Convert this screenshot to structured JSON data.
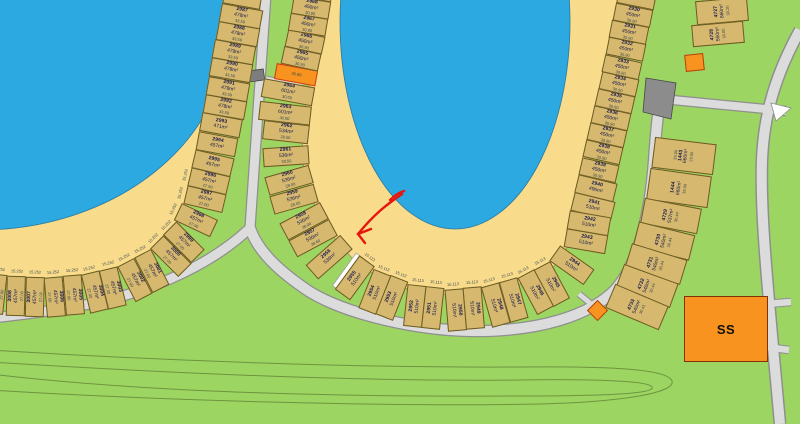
{
  "colors": {
    "water": "#2ba9e0",
    "sand": "#f8db8b",
    "grass": "#9cd561",
    "road": "#dcdcdc",
    "lot_fill": "#d6b96e",
    "orange": "#f7931e",
    "arrow": "#e8150d"
  },
  "buildings": {
    "ss_label": "SS"
  },
  "annotation": {
    "color": "#e8150d"
  },
  "rings": {
    "right": {
      "lots": [
        {
          "p": true
        },
        {
          "n": "2930",
          "a": "450m²",
          "d": "30.90"
        },
        {
          "n": "2931",
          "a": "450m²",
          "d": "30.90"
        },
        {
          "n": "2932",
          "a": "450m²",
          "d": "30.90"
        },
        {
          "n": "2933",
          "a": "450m²",
          "d": "30.90"
        },
        {
          "n": "2934",
          "a": "450m²",
          "d": "30.90"
        },
        {
          "n": "2935",
          "a": "450m²",
          "d": "30.90"
        },
        {
          "n": "2936",
          "a": "450m²",
          "d": "30.90"
        },
        {
          "n": "2937",
          "a": "450m²",
          "d": "30.90"
        },
        {
          "n": "2938",
          "a": "450m²",
          "d": "30.90"
        },
        {
          "n": "2939",
          "a": "450m²",
          "d": "30.90"
        },
        {
          "n": "2940",
          "a": "496m²"
        },
        {
          "n": "2941",
          "a": "510m²"
        },
        {
          "n": "2942",
          "a": "510m²"
        },
        {
          "n": "2943",
          "a": "510m²"
        },
        {
          "n": "2944",
          "a": "510m²"
        },
        {
          "n": "2945",
          "a": "510m²",
          "f": "15.113"
        },
        {
          "n": "2946",
          "a": "510m²",
          "f": "15.113"
        },
        {
          "n": "2947",
          "a": "510m²",
          "f": "15.113"
        },
        {
          "n": "2948",
          "a": "510m²",
          "f": "15.113"
        },
        {
          "n": "2949",
          "a": "510m²",
          "f": "15.113"
        },
        {
          "n": "2950",
          "a": "510m²",
          "f": "15.113"
        },
        {
          "n": "2951",
          "a": "510m²",
          "f": "15.113"
        },
        {
          "n": "2952",
          "a": "510m²",
          "f": "15.113"
        },
        {
          "n": "2953",
          "a": "510m²",
          "f": "15.113"
        },
        {
          "n": "2954",
          "a": "510m²",
          "f": "15.113"
        },
        {
          "n": "2955",
          "a": "510m²",
          "f": "15.113"
        },
        {
          "g": true
        },
        {
          "n": "2956",
          "a": "536m²"
        },
        {
          "n": "2957",
          "a": "536m²",
          "d": "28.60"
        },
        {
          "n": "2958",
          "a": "536m²",
          "d": "28.00"
        },
        {
          "n": "2959",
          "a": "536m²",
          "d": "28.00"
        },
        {
          "n": "2960",
          "a": "536m²",
          "d": "28.00"
        },
        {
          "n": "2961",
          "a": "536m²",
          "d": "28.50"
        },
        {
          "n": "2962",
          "a": "534m²",
          "d": "28.50"
        },
        {
          "n": "2963",
          "a": "601m²",
          "d": "30.00"
        },
        {
          "n": "2964",
          "a": "601m²",
          "d": "30.00"
        },
        {
          "o": true,
          "d": "35.99"
        },
        {
          "n": "2965",
          "a": "450m²",
          "d": "30.90"
        },
        {
          "n": "2966",
          "a": "450m²",
          "d": "30.90"
        },
        {
          "n": "2967",
          "a": "450m²",
          "d": "30.90"
        },
        {
          "n": "2968",
          "a": "450m²",
          "d": "30.90"
        },
        {
          "p": true
        }
      ]
    },
    "left": {
      "lots": [
        {
          "p": true
        },
        {
          "n": "2987",
          "a": "478m²",
          "d": "33.59"
        },
        {
          "n": "2988",
          "a": "478m²",
          "d": "33.59"
        },
        {
          "n": "2989",
          "a": "478m²",
          "d": "33.59"
        },
        {
          "n": "2990",
          "a": "478m²",
          "d": "33.59"
        },
        {
          "n": "2991",
          "a": "478m²",
          "d": "33.59"
        },
        {
          "n": "2992",
          "a": "478m²",
          "d": "33.59"
        },
        {
          "n": "2993",
          "a": "471m²"
        },
        {
          "n": "2994",
          "a": "457m²"
        },
        {
          "n": "2995",
          "a": "457m²"
        },
        {
          "n": "2996",
          "a": "457m²",
          "d": "27.00",
          "f": "15.252"
        },
        {
          "n": "2997",
          "a": "457m²",
          "d": "27.00",
          "f": "15.252"
        },
        {
          "n": "2998",
          "a": "457m²",
          "d": "27.00",
          "f": "15.252"
        },
        {
          "n": "2999",
          "a": "457m²",
          "d": "27.00",
          "f": "15.252"
        },
        {
          "n": "3000",
          "a": "457m²",
          "d": "27.00",
          "f": "15.252"
        },
        {
          "n": "3001",
          "a": "457m²",
          "d": "27.00",
          "f": "15.252"
        },
        {
          "n": "3002",
          "a": "457m²",
          "d": "27.00",
          "f": "15.252"
        },
        {
          "n": "3003",
          "a": "457m²",
          "d": "27.00",
          "f": "15.252"
        },
        {
          "n": "3004",
          "a": "457m²",
          "d": "27.00",
          "f": "15.252"
        },
        {
          "n": "3005",
          "a": "457m²",
          "d": "27.00",
          "f": "15.252"
        },
        {
          "n": "3006",
          "a": "457m²",
          "d": "27.00",
          "f": "15.252"
        },
        {
          "n": "3007",
          "a": "457m²",
          "d": "27.00",
          "f": "15.252"
        },
        {
          "n": "3008",
          "a": "457m²",
          "d": "27.00",
          "f": "15.252"
        },
        {
          "n": "3009",
          "a": "457m²",
          "d": "27.00",
          "f": "15.252"
        },
        {
          "p": true
        }
      ]
    }
  },
  "columns": {
    "c4727": {
      "lots": [
        {
          "p": true
        },
        {
          "n": "4727",
          "a": "660m²",
          "d": "33.20"
        },
        {
          "n": "4728",
          "a": "550m²",
          "d": "33.00"
        }
      ]
    },
    "c1443": {
      "lots": [
        {
          "n": "1443",
          "a": "660m²",
          "d": "23.00",
          "t": "33.00"
        },
        {
          "n": "1444",
          "a": "660m²",
          "d": "35.00"
        },
        {
          "n": "4729",
          "a": "537m²",
          "d": "30.44"
        },
        {
          "n": "4730",
          "a": "540m²",
          "d": "30.44"
        },
        {
          "n": "4731",
          "a": "540m²",
          "d": "30.44"
        },
        {
          "n": "4732",
          "a": "540m²",
          "d": "30.44"
        },
        {
          "n": "4733",
          "a": "540m²",
          "d": "30.41"
        }
      ]
    }
  }
}
